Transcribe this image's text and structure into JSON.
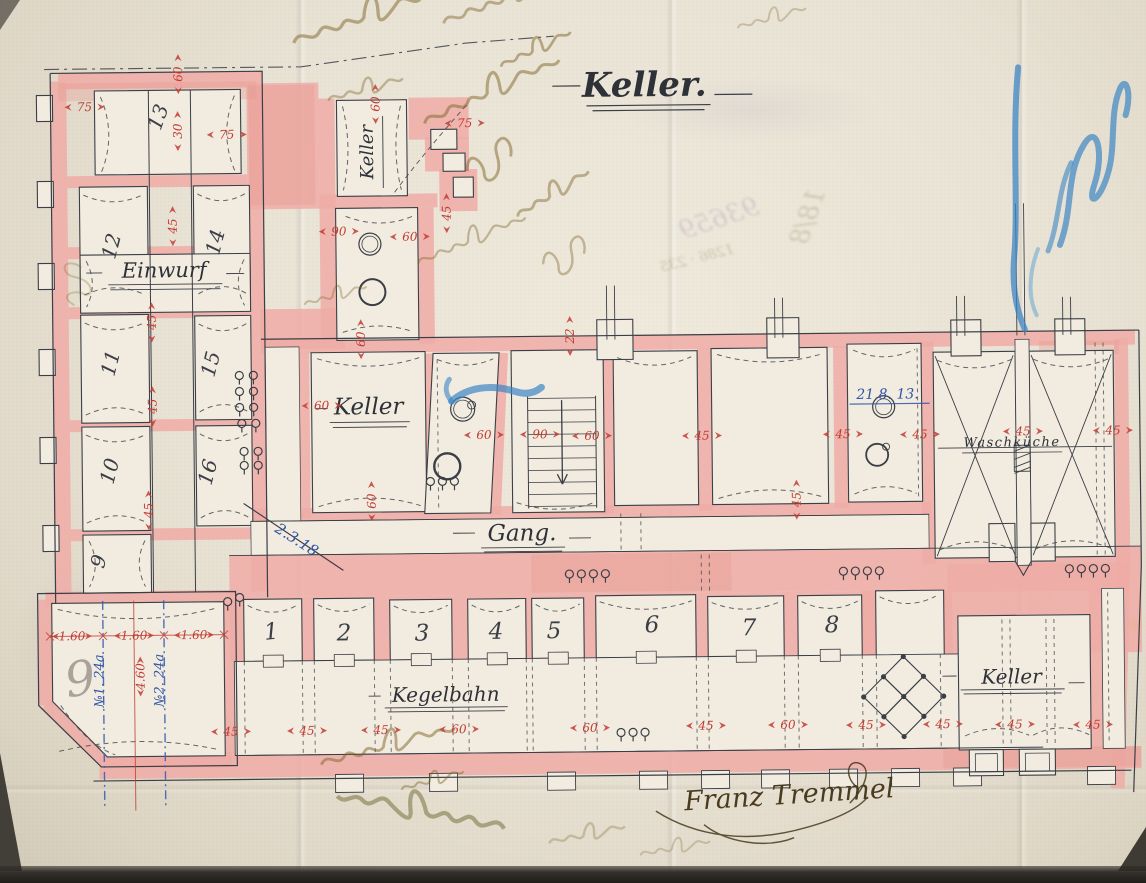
{
  "plan": {
    "title": "Keller.",
    "signature": "Franz Tremmel",
    "labels": {
      "keller_annex": "Keller",
      "keller_mid": "Keller",
      "einwurf": "Einwurf",
      "gang": "Gang.",
      "kegelbahn": "Kegelbahn",
      "waschkueche": "Waschküche",
      "keller_bottom_right": "Keller"
    },
    "annotations_blue": {
      "date_diagonal": "2.3.18",
      "date_right": "21.8. 13.",
      "mark_no1": "№1. 24a",
      "mark_no2": "№2. 24a"
    },
    "room_numbers": [
      {
        "n": "13",
        "x": 168,
        "y": 115,
        "r": -70,
        "s": 20
      },
      {
        "n": "12",
        "x": 120,
        "y": 243,
        "r": -75,
        "s": 20
      },
      {
        "n": "14",
        "x": 224,
        "y": 240,
        "r": -75,
        "s": 20
      },
      {
        "n": "11",
        "x": 118,
        "y": 360,
        "r": -75,
        "s": 20
      },
      {
        "n": "15",
        "x": 218,
        "y": 362,
        "r": -75,
        "s": 20
      },
      {
        "n": "10",
        "x": 116,
        "y": 468,
        "r": -75,
        "s": 20
      },
      {
        "n": "16",
        "x": 214,
        "y": 470,
        "r": -75,
        "s": 20
      },
      {
        "n": "9",
        "x": 104,
        "y": 558,
        "r": -75,
        "s": 20
      },
      {
        "n": "9",
        "x": 80,
        "y": 690,
        "r": -8,
        "s": 48,
        "c": "#a9a298"
      },
      {
        "n": "1",
        "x": 270,
        "y": 636,
        "r": -5,
        "s": 23
      },
      {
        "n": "2",
        "x": 342,
        "y": 638,
        "r": 0,
        "s": 23
      },
      {
        "n": "3",
        "x": 420,
        "y": 639,
        "r": 0,
        "s": 23
      },
      {
        "n": "4",
        "x": 494,
        "y": 638,
        "r": 0,
        "s": 23
      },
      {
        "n": "5",
        "x": 552,
        "y": 638,
        "r": 0,
        "s": 23
      },
      {
        "n": "6",
        "x": 650,
        "y": 633,
        "r": 0,
        "s": 23
      },
      {
        "n": "7",
        "x": 747,
        "y": 637,
        "r": 0,
        "s": 23
      },
      {
        "n": "8",
        "x": 830,
        "y": 635,
        "r": 0,
        "s": 23
      }
    ],
    "dimensions": [
      {
        "v": "75",
        "x": 88,
        "y": 101,
        "r": 0
      },
      {
        "v": "60",
        "x": 181,
        "y": 70,
        "r": -90
      },
      {
        "v": "75",
        "x": 230,
        "y": 130,
        "r": 0
      },
      {
        "v": "30",
        "x": 180,
        "y": 127,
        "r": -90
      },
      {
        "v": "45",
        "x": 174,
        "y": 222,
        "r": -90
      },
      {
        "v": "45",
        "x": 152,
        "y": 318,
        "r": -90
      },
      {
        "v": "45",
        "x": 152,
        "y": 402,
        "r": -90
      },
      {
        "v": "45",
        "x": 147,
        "y": 506,
        "r": -90
      },
      {
        "v": "60",
        "x": 378,
        "y": 102,
        "r": -90
      },
      {
        "v": "75",
        "x": 468,
        "y": 121,
        "r": 0
      },
      {
        "v": "45",
        "x": 448,
        "y": 212,
        "r": -90
      },
      {
        "v": "60",
        "x": 412,
        "y": 234,
        "r": 0
      },
      {
        "v": "90",
        "x": 341,
        "y": 228,
        "r": 0
      },
      {
        "v": "60",
        "x": 361,
        "y": 337,
        "r": -90
      },
      {
        "v": "22",
        "x": 570,
        "y": 336,
        "r": -90
      },
      {
        "v": "60",
        "x": 322,
        "y": 402,
        "r": 0
      },
      {
        "v": "60",
        "x": 370,
        "y": 499,
        "r": -90
      },
      {
        "v": "60",
        "x": 484,
        "y": 433,
        "r": 0
      },
      {
        "v": "90",
        "x": 540,
        "y": 433,
        "r": 0
      },
      {
        "v": "60",
        "x": 592,
        "y": 435,
        "r": 0
      },
      {
        "v": "45",
        "x": 702,
        "y": 436,
        "r": 0
      },
      {
        "v": "45",
        "x": 843,
        "y": 436,
        "r": 0
      },
      {
        "v": "45",
        "x": 920,
        "y": 437,
        "r": 0
      },
      {
        "v": "45",
        "x": 1023,
        "y": 435,
        "r": 0
      },
      {
        "v": "45",
        "x": 1113,
        "y": 435,
        "r": 0
      },
      {
        "v": "45",
        "x": 795,
        "y": 502,
        "r": -90
      },
      {
        "v": "1.60",
        "x": 70,
        "y": 630,
        "r": 0
      },
      {
        "v": "1.60",
        "x": 132,
        "y": 630,
        "r": 0
      },
      {
        "v": "1.60",
        "x": 192,
        "y": 630,
        "r": 0
      },
      {
        "v": "4.60",
        "x": 137,
        "y": 672,
        "r": -90
      },
      {
        "v": "45",
        "x": 228,
        "y": 727,
        "r": 0
      },
      {
        "v": "45",
        "x": 304,
        "y": 727,
        "r": 0
      },
      {
        "v": "45",
        "x": 378,
        "y": 727,
        "r": 0
      },
      {
        "v": "60",
        "x": 456,
        "y": 727,
        "r": 0
      },
      {
        "v": "60",
        "x": 587,
        "y": 727,
        "r": 0
      },
      {
        "v": "45",
        "x": 703,
        "y": 726,
        "r": 0
      },
      {
        "v": "60",
        "x": 785,
        "y": 726,
        "r": 0
      },
      {
        "v": "45",
        "x": 863,
        "y": 727,
        "r": 0
      },
      {
        "v": "45",
        "x": 940,
        "y": 727,
        "r": 0
      },
      {
        "v": "45",
        "x": 1012,
        "y": 728,
        "r": 0
      },
      {
        "v": "45",
        "x": 1090,
        "y": 729,
        "r": 0
      }
    ],
    "ghost_marks": [
      {
        "t": "93659",
        "x": 724,
        "y": 228,
        "r": -18,
        "s": 26,
        "c": "rgba(120,95,150,0.20)"
      },
      {
        "t": "1286 · 235",
        "x": 700,
        "y": 264,
        "r": -14,
        "s": 14,
        "c": "rgba(115,100,55,0.28)"
      },
      {
        "t": "18/8",
        "x": 818,
        "y": 222,
        "r": -70,
        "s": 26,
        "c": "rgba(115,100,55,0.22)"
      }
    ],
    "colors": {
      "wall_pink": "#efaca6",
      "ink": "#3b3e46",
      "dimension_red": "#c23b34",
      "blue_ink": "#2f54a8",
      "blue_crayon": "#3c86c4",
      "paper": "#e9e3d5"
    }
  }
}
